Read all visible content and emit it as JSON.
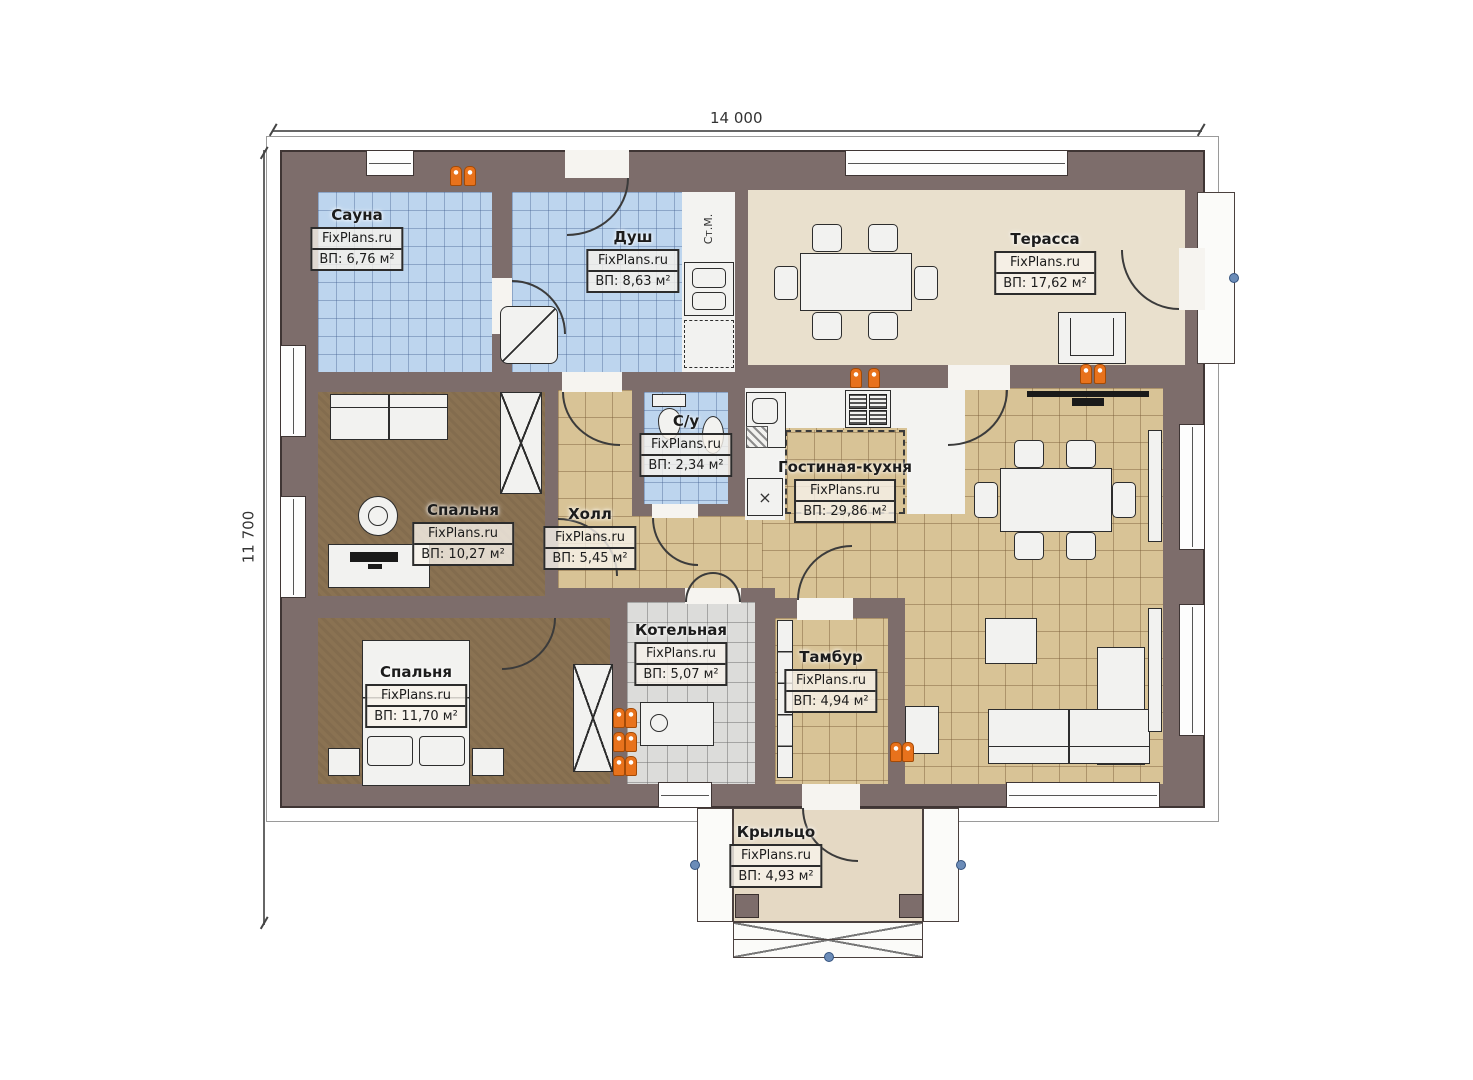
{
  "watermark": "FixPlans.ru",
  "dimensions": {
    "width_label": "14 000",
    "height_label": "11 700"
  },
  "rooms": [
    {
      "id": "sauna",
      "name": "Сауна",
      "area": "ВП: 6,76 м²"
    },
    {
      "id": "shower",
      "name": "Душ",
      "area": "ВП: 8,63 м²"
    },
    {
      "id": "terrace",
      "name": "Терасса",
      "area": "ВП: 17,62 м²"
    },
    {
      "id": "wc",
      "name": "С/у",
      "area": "ВП: 2,34 м²"
    },
    {
      "id": "living-kitchen",
      "name": "Гостиная-кухня",
      "area": "ВП: 29,86 м²"
    },
    {
      "id": "bedroom-1",
      "name": "Спальня",
      "area": "ВП: 10,27 м²"
    },
    {
      "id": "hall",
      "name": "Холл",
      "area": "ВП: 5,45 м²"
    },
    {
      "id": "bedroom-2",
      "name": "Спальня",
      "area": "ВП: 11,70 м²"
    },
    {
      "id": "boiler-room",
      "name": "Котельная",
      "area": "ВП: 5,07 м²"
    },
    {
      "id": "vestibule",
      "name": "Тамбур",
      "area": "ВП: 4,94 м²"
    },
    {
      "id": "porch",
      "name": "Крыльцо",
      "area": "ВП: 4,93 м²"
    }
  ],
  "annotations": {
    "washing_machine": "Ст.М.",
    "symbol_x": "×"
  },
  "colors": {
    "wall": "#7d6d6b",
    "tile_blue": "#bdd5ee",
    "tile_beige": "#d8c396",
    "floor_bedroom": "#8a7252",
    "tile_gray": "#dcdcda",
    "terrace_floor": "#e9e0cd",
    "heater_orange": "#e8721c"
  }
}
